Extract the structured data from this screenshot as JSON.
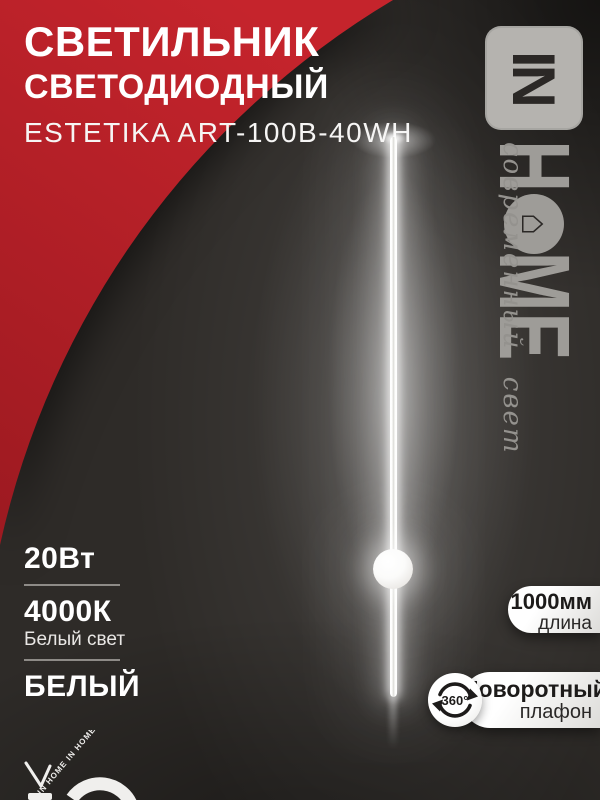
{
  "product": {
    "title_line1": "СВЕТИЛЬНИК",
    "title_line2": "СВЕТОДИОДНЫЙ",
    "model": "ESTETIKA ART-100B-40WH"
  },
  "brand": {
    "badge": "IN",
    "letter_h": "H",
    "letter_m": "M",
    "letter_e": "E",
    "house_icon": "⌂",
    "tagline": "современный свет",
    "watermark": "IN HOME  IN HOME"
  },
  "specs": {
    "power": "20Вт",
    "temperature": "4000К",
    "temperature_note": "Белый свет",
    "color": "БЕЛЫЙ"
  },
  "badges": {
    "length": {
      "value": "1000мм",
      "label": "длина"
    },
    "rotation": {
      "icon_text": "360°",
      "title": "Поворотный",
      "label": "плафон"
    }
  },
  "colors": {
    "red": "#c5242c",
    "red_dark": "#9e1a21",
    "background": "#2e2b28",
    "logo_grey": "#9e9c98",
    "text_white": "#ffffff",
    "badge_text_dark": "#1d1b1a"
  }
}
